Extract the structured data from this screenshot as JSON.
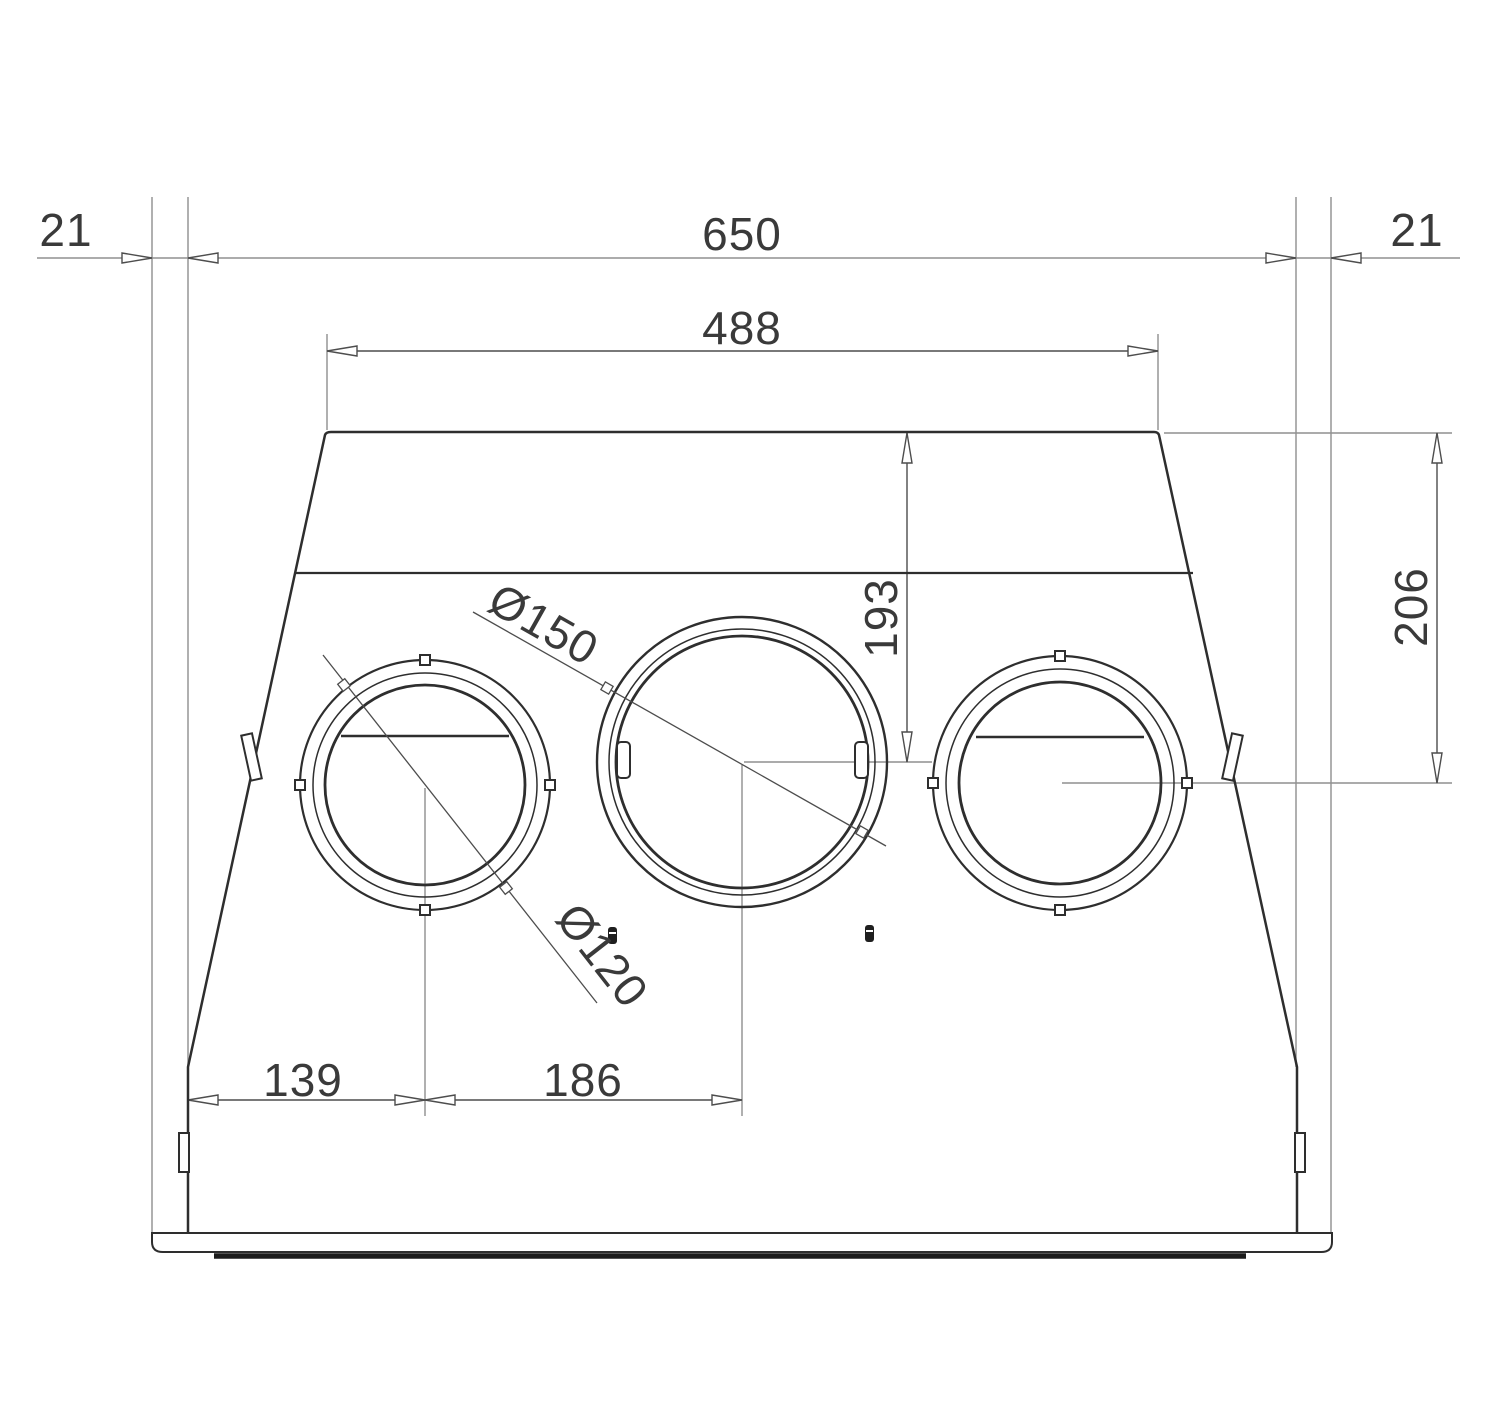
{
  "drawing": {
    "labels": {
      "overhang_left": "21",
      "overall_width": "650",
      "overhang_right": "21",
      "top_width": "488",
      "depth_center": "193",
      "depth_side": "206",
      "diameter_large": "Ø150",
      "diameter_small": "Ø120",
      "offset_left": "139",
      "offset_center": "186"
    },
    "colors": {
      "outline": "#2e2e2e",
      "dimension": "#4d4d4d",
      "extension": "#8f8f8f",
      "text": "#3a3a3a",
      "background": "#ffffff"
    }
  }
}
